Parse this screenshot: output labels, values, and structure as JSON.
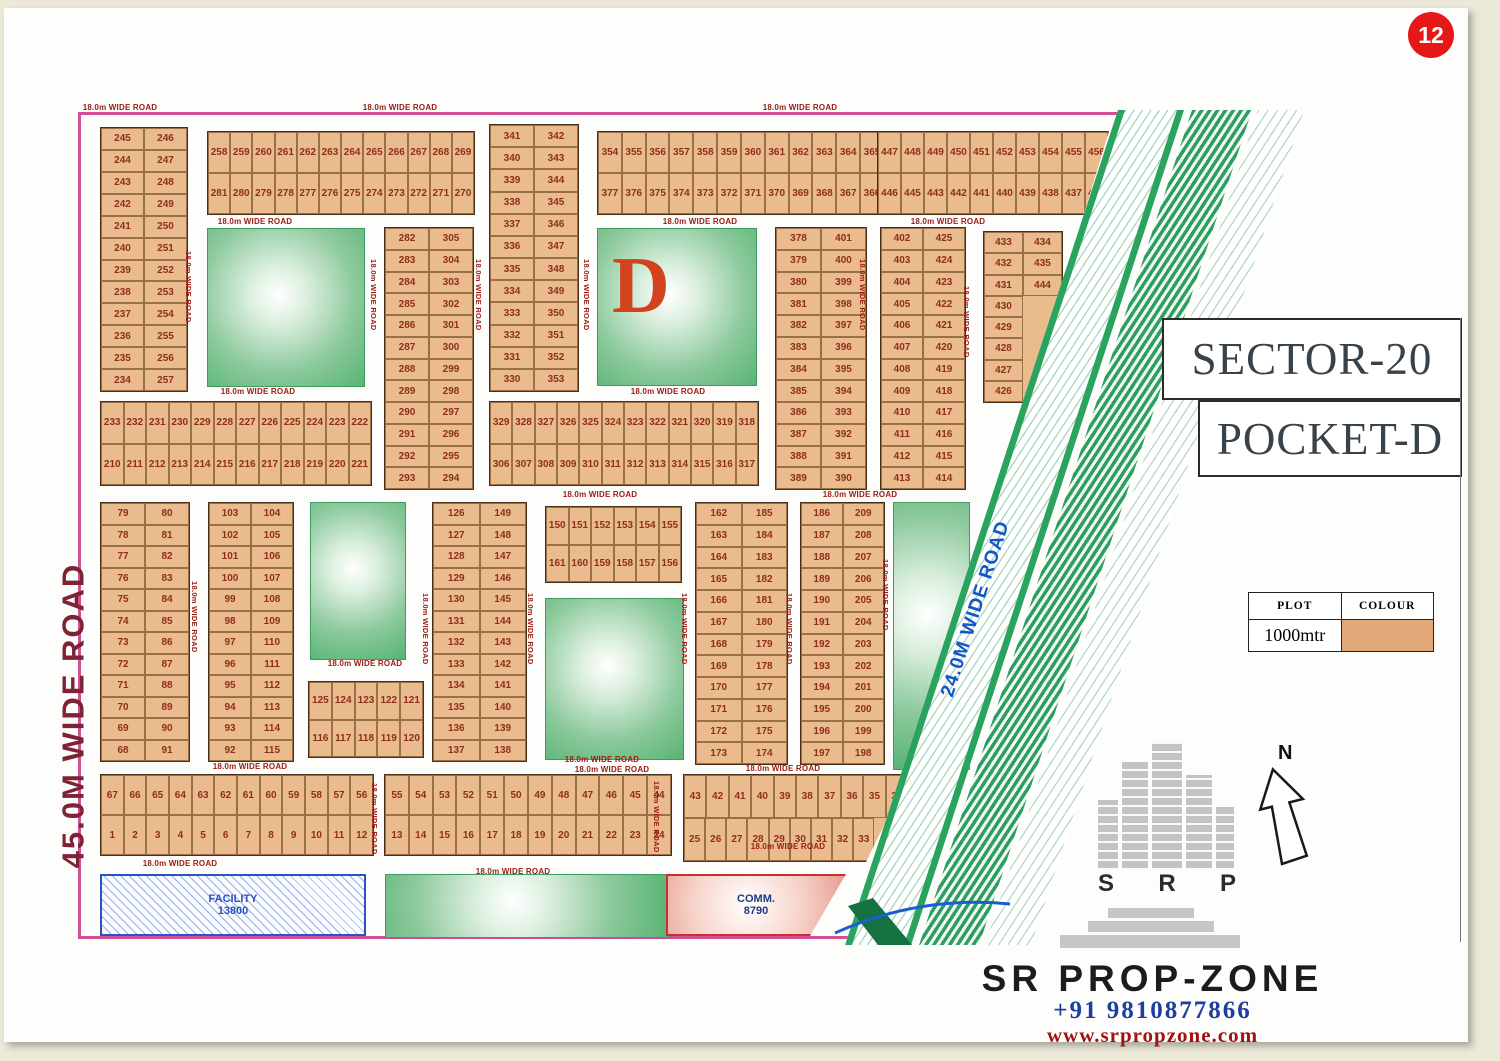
{
  "page_badge": "12",
  "titles": {
    "sector": "SECTOR-20",
    "pocket": "POCKET-D"
  },
  "legend": {
    "header_plot": "PLOT",
    "header_colour": "COLOUR",
    "plot_size": "1000mtr",
    "swatch_color": "#e2a878"
  },
  "roads": {
    "left_main": "45.0M WIDE ROAD",
    "diagonal": "24.0M WIDE ROAD",
    "standard": "18.0m WIDE ROAD"
  },
  "special_plots": {
    "facility": {
      "label": "FACILITY",
      "area": "13800"
    },
    "commercial": {
      "label": "COMM.",
      "area": "8790"
    },
    "park_letter": "D"
  },
  "compass": {
    "north_label": "N"
  },
  "branding": {
    "logo_letters": [
      "S",
      "R",
      "P"
    ],
    "name": "SR PROP-ZONE",
    "phone": "+91 9810877866",
    "website": "www.srpropzone.com"
  },
  "colors": {
    "plot_fill": "#e9bb8d",
    "plot_number": "#8f2e1c",
    "park_green": "#57b474",
    "road_label": "#9b1b12",
    "boundary_pink": "#d14f95",
    "facility_blue": "#2a52c4",
    "comm_red": "#c53030",
    "band_green": "#2aa35e",
    "diagonal_road_text": "#1356c9"
  },
  "plot_blocks": {
    "A": [
      [
        "245",
        "246"
      ],
      [
        "244",
        "247"
      ],
      [
        "243",
        "248"
      ],
      [
        "242",
        "249"
      ],
      [
        "241",
        "250"
      ],
      [
        "240",
        "251"
      ],
      [
        "239",
        "252"
      ],
      [
        "238",
        "253"
      ],
      [
        "237",
        "254"
      ],
      [
        "236",
        "255"
      ],
      [
        "235",
        "256"
      ],
      [
        "234",
        "257"
      ]
    ],
    "B": [
      [
        "258",
        "259",
        "260",
        "261",
        "262",
        "263",
        "264",
        "265",
        "266",
        "267",
        "268",
        "269"
      ],
      [
        "281",
        "280",
        "279",
        "278",
        "277",
        "276",
        "275",
        "274",
        "273",
        "272",
        "271",
        "270"
      ]
    ],
    "C": [
      [
        "341",
        "342"
      ],
      [
        "340",
        "343"
      ],
      [
        "339",
        "344"
      ],
      [
        "338",
        "345"
      ],
      [
        "337",
        "346"
      ],
      [
        "336",
        "347"
      ],
      [
        "335",
        "348"
      ],
      [
        "334",
        "349"
      ],
      [
        "333",
        "350"
      ],
      [
        "332",
        "351"
      ],
      [
        "331",
        "352"
      ],
      [
        "330",
        "353"
      ]
    ],
    "D": [
      [
        "354",
        "355",
        "356",
        "357",
        "358",
        "359",
        "360",
        "361",
        "362",
        "363",
        "364",
        "365"
      ],
      [
        "377",
        "376",
        "375",
        "374",
        "373",
        "372",
        "371",
        "370",
        "369",
        "368",
        "367",
        "366"
      ]
    ],
    "E": [
      [
        "447",
        "448",
        "449",
        "450",
        "451",
        "452",
        "453",
        "454",
        "455",
        "456"
      ],
      [
        "446",
        "445",
        "443",
        "442",
        "441",
        "440",
        "439",
        "438",
        "437",
        "436"
      ]
    ],
    "F": [
      [
        "378",
        "401"
      ],
      [
        "379",
        "400"
      ],
      [
        "380",
        "399"
      ],
      [
        "381",
        "398"
      ],
      [
        "382",
        "397"
      ],
      [
        "383",
        "396"
      ],
      [
        "384",
        "395"
      ],
      [
        "385",
        "394"
      ],
      [
        "386",
        "393"
      ],
      [
        "387",
        "392"
      ],
      [
        "388",
        "391"
      ],
      [
        "389",
        "390"
      ]
    ],
    "G": [
      [
        "402",
        "425"
      ],
      [
        "403",
        "424"
      ],
      [
        "404",
        "423"
      ],
      [
        "405",
        "422"
      ],
      [
        "406",
        "421"
      ],
      [
        "407",
        "420"
      ],
      [
        "408",
        "419"
      ],
      [
        "409",
        "418"
      ],
      [
        "410",
        "417"
      ],
      [
        "411",
        "416"
      ],
      [
        "412",
        "415"
      ],
      [
        "413",
        "414"
      ]
    ],
    "H": [
      [
        "433",
        "434"
      ],
      [
        "432",
        "435"
      ],
      [
        "431",
        "444"
      ],
      [
        "430"
      ],
      [
        "429"
      ],
      [
        "428"
      ],
      [
        "427"
      ],
      [
        "426"
      ]
    ],
    "I": [
      [
        "282",
        "305"
      ],
      [
        "283",
        "304"
      ],
      [
        "284",
        "303"
      ],
      [
        "285",
        "302"
      ],
      [
        "286",
        "301"
      ],
      [
        "287",
        "300"
      ],
      [
        "288",
        "299"
      ],
      [
        "289",
        "298"
      ],
      [
        "290",
        "297"
      ],
      [
        "291",
        "296"
      ],
      [
        "292",
        "295"
      ],
      [
        "293",
        "294"
      ]
    ],
    "J": [
      [
        "329",
        "328",
        "327",
        "326",
        "325",
        "324",
        "323",
        "322",
        "321",
        "320",
        "319",
        "318"
      ],
      [
        "306",
        "307",
        "308",
        "309",
        "310",
        "311",
        "312",
        "313",
        "314",
        "315",
        "316",
        "317"
      ]
    ],
    "K": [
      [
        "233",
        "232",
        "231",
        "230",
        "229",
        "228",
        "227",
        "226",
        "225",
        "224",
        "223",
        "222"
      ],
      [
        "210",
        "211",
        "212",
        "213",
        "214",
        "215",
        "216",
        "217",
        "218",
        "219",
        "220",
        "221"
      ]
    ],
    "L": [
      [
        "79",
        "80"
      ],
      [
        "78",
        "81"
      ],
      [
        "77",
        "82"
      ],
      [
        "76",
        "83"
      ],
      [
        "75",
        "84"
      ],
      [
        "74",
        "85"
      ],
      [
        "73",
        "86"
      ],
      [
        "72",
        "87"
      ],
      [
        "71",
        "88"
      ],
      [
        "70",
        "89"
      ],
      [
        "69",
        "90"
      ],
      [
        "68",
        "91"
      ]
    ],
    "M": [
      [
        "103",
        "104"
      ],
      [
        "102",
        "105"
      ],
      [
        "101",
        "106"
      ],
      [
        "100",
        "107"
      ],
      [
        "99",
        "108"
      ],
      [
        "98",
        "109"
      ],
      [
        "97",
        "110"
      ],
      [
        "96",
        "111"
      ],
      [
        "95",
        "112"
      ],
      [
        "94",
        "113"
      ],
      [
        "93",
        "114"
      ],
      [
        "92",
        "115"
      ]
    ],
    "N": [
      [
        "126",
        "149"
      ],
      [
        "127",
        "148"
      ],
      [
        "128",
        "147"
      ],
      [
        "129",
        "146"
      ],
      [
        "130",
        "145"
      ],
      [
        "131",
        "144"
      ],
      [
        "132",
        "143"
      ],
      [
        "133",
        "142"
      ],
      [
        "134",
        "141"
      ],
      [
        "135",
        "140"
      ],
      [
        "136",
        "139"
      ],
      [
        "137",
        "138"
      ]
    ],
    "O": [
      [
        "150",
        "151",
        "152",
        "153",
        "154",
        "155"
      ],
      [
        "161",
        "160",
        "159",
        "158",
        "157",
        "156"
      ]
    ],
    "P": [
      [
        "162",
        "185"
      ],
      [
        "163",
        "184"
      ],
      [
        "164",
        "183"
      ],
      [
        "165",
        "182"
      ],
      [
        "166",
        "181"
      ],
      [
        "167",
        "180"
      ],
      [
        "168",
        "179"
      ],
      [
        "169",
        "178"
      ],
      [
        "170",
        "177"
      ],
      [
        "171",
        "176"
      ],
      [
        "172",
        "175"
      ],
      [
        "173",
        "174"
      ]
    ],
    "Q": [
      [
        "186",
        "209"
      ],
      [
        "187",
        "208"
      ],
      [
        "188",
        "207"
      ],
      [
        "189",
        "206"
      ],
      [
        "190",
        "205"
      ],
      [
        "191",
        "204"
      ],
      [
        "192",
        "203"
      ],
      [
        "193",
        "202"
      ],
      [
        "194",
        "201"
      ],
      [
        "195",
        "200"
      ],
      [
        "196",
        "199"
      ],
      [
        "197",
        "198"
      ]
    ],
    "R": [
      [
        "125",
        "124",
        "123",
        "122",
        "121"
      ],
      [
        "116",
        "117",
        "118",
        "119",
        "120"
      ]
    ],
    "S": [
      [
        "67",
        "66",
        "65",
        "64",
        "63",
        "62",
        "61",
        "60",
        "59",
        "58",
        "57",
        "56"
      ],
      [
        "1",
        "2",
        "3",
        "4",
        "5",
        "6",
        "7",
        "8",
        "9",
        "10",
        "11",
        "12"
      ]
    ],
    "T": [
      [
        "55",
        "54",
        "53",
        "52",
        "51",
        "50",
        "49",
        "48",
        "47",
        "46",
        "45",
        "44"
      ],
      [
        "13",
        "14",
        "15",
        "16",
        "17",
        "18",
        "19",
        "20",
        "21",
        "22",
        "23",
        "24"
      ]
    ],
    "U": [
      [
        "43",
        "42",
        "41",
        "40",
        "39",
        "38",
        "37",
        "36",
        "35",
        "34"
      ],
      [
        "25",
        "26",
        "27",
        "28",
        "29",
        "30",
        "31",
        "32",
        "33"
      ]
    ]
  }
}
